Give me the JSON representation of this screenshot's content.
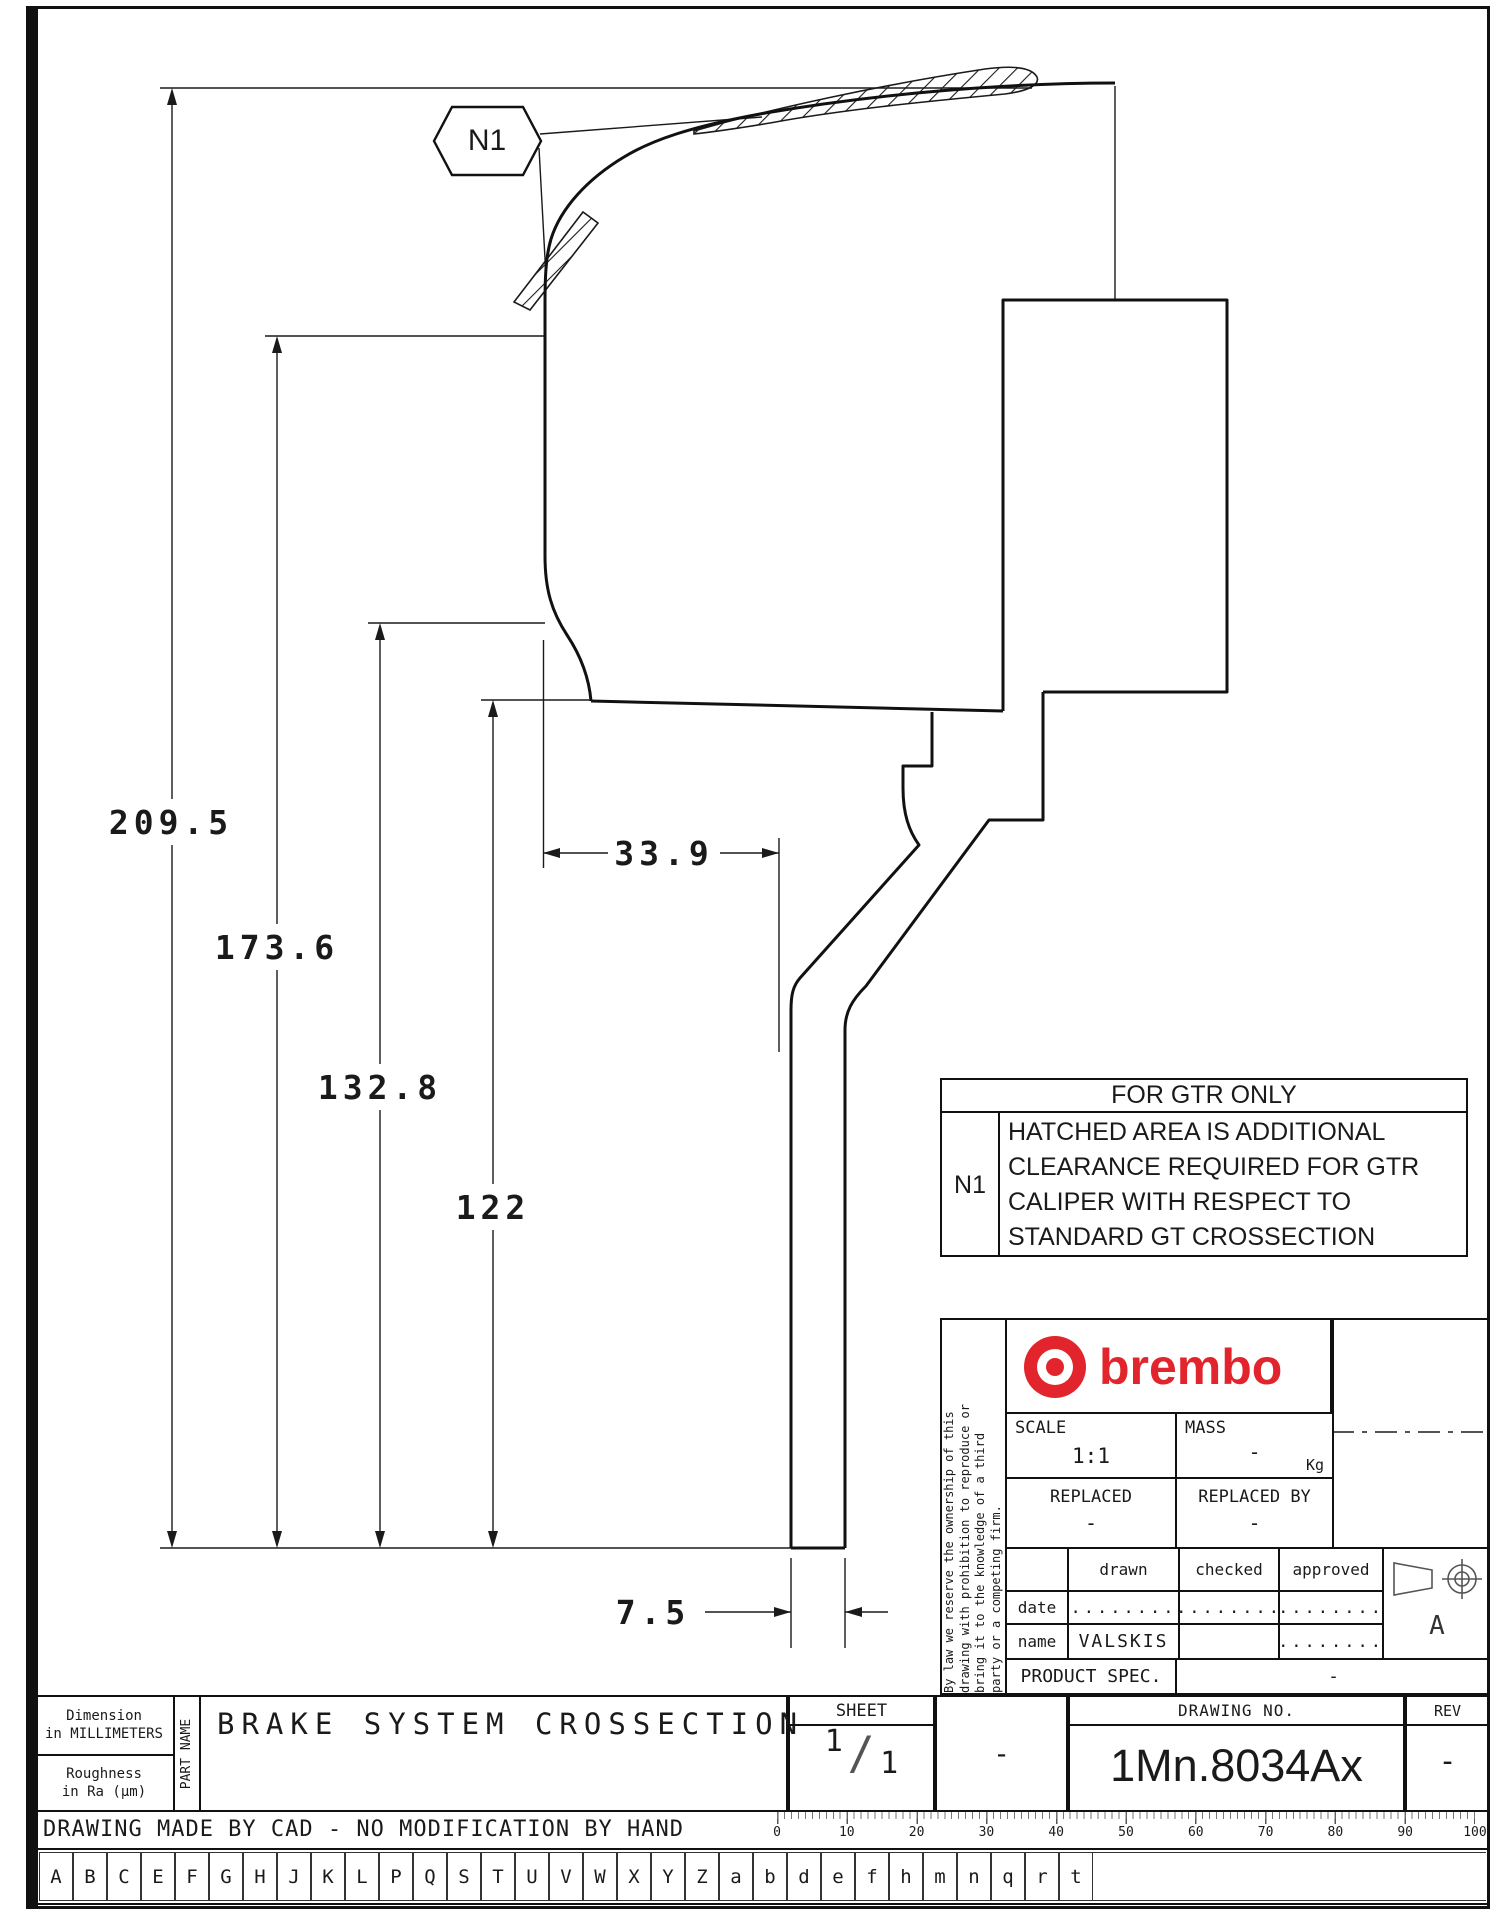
{
  "colors": {
    "line": "#1a1a1a",
    "brembo_red": "#e2242c"
  },
  "callout": {
    "label": "N1"
  },
  "dims": {
    "d1": "209.5",
    "d2": "173.6",
    "d3": "132.8",
    "d4": "122",
    "d5": "33.9",
    "d6": "7.5"
  },
  "note_table": {
    "header": "FOR GTR ONLY",
    "ref": "N1",
    "lines": [
      "HATCHED AREA IS ADDITIONAL",
      "CLEARANCE REQUIRED FOR GTR",
      "CALIPER WITH RESPECT TO",
      "STANDARD GT CROSSECTION"
    ]
  },
  "title_block": {
    "brand": "brembo",
    "scale_label": "SCALE",
    "scale_value": "1:1",
    "mass_label": "MASS",
    "mass_value": "-",
    "mass_unit": "Kg",
    "replaced_label": "REPLACED",
    "replaced_value": "-",
    "replaced_by_label": "REPLACED BY",
    "replaced_by_value": "-",
    "col_drawn": "drawn",
    "col_checked": "checked",
    "col_approved": "approved",
    "row_date": "date",
    "row_name": "name",
    "date_drawn": "........",
    "date_checked": "........",
    "date_approved": "........",
    "name_drawn": "VALSKIS",
    "name_approved": "........",
    "product_spec_label": "PRODUCT SPEC.",
    "product_spec_value": "-",
    "proj_letter": "A",
    "disclaimer_line1": "By law we reserve the ownership of this",
    "disclaimer_line2": "drawing with prohibition to reproduce or",
    "disclaimer_line3": "bring it to the knowledge of a third",
    "disclaimer_line4": "party or a competing firm."
  },
  "footer": {
    "sheet_label": "SHEET",
    "sheet_num": "1",
    "sheet_slash": "/",
    "sheet_den": "1",
    "sheet_dash": "-",
    "drawing_no_label": "DRAWING NO.",
    "drawing_no_value": "1Mn.8034Ax",
    "rev_label": "REV",
    "rev_value": "-",
    "dim_line1": "Dimension",
    "dim_line2": "in MILLIMETERS",
    "rough_line1": "Roughness",
    "rough_line2": "in Ra (µm)",
    "part_name_label": "PART NAME",
    "part_name": "BRAKE SYSTEM CROSSECTION",
    "cad_note": "DRAWING MADE BY CAD - NO MODIFICATION BY HAND",
    "ruler_numbers": [
      "0",
      "10",
      "20",
      "30",
      "40",
      "50",
      "60",
      "70",
      "80",
      "90",
      "100"
    ],
    "letters": [
      "A",
      "B",
      "C",
      "E",
      "F",
      "G",
      "H",
      "J",
      "K",
      "L",
      "P",
      "Q",
      "S",
      "T",
      "U",
      "V",
      "W",
      "X",
      "Y",
      "Z",
      "a",
      "b",
      "d",
      "e",
      "f",
      "h",
      "m",
      "n",
      "q",
      "r",
      "t"
    ]
  }
}
